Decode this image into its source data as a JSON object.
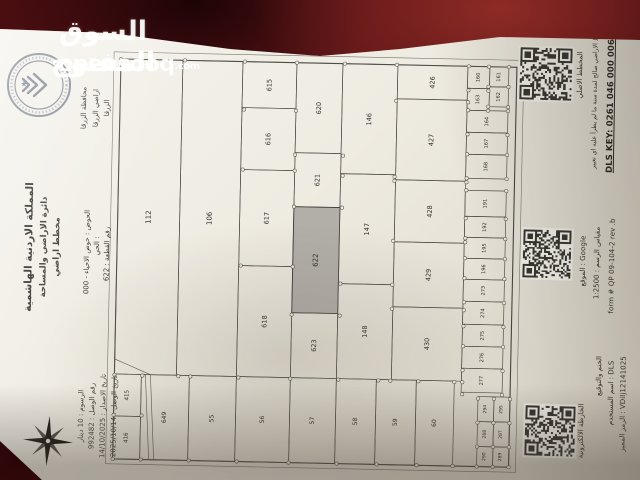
{
  "watermark": {
    "title_ar": "السوق المفتوح",
    "brand": "opensooq",
    "tld": ".com"
  },
  "paper": {
    "region": [
      "محافظة الزرقا",
      "اراضي الزرقا",
      "الزرقا"
    ],
    "header": [
      "المملكة الاردنية الهاشمية",
      "دائرة الاراضي والمساحة",
      "مخطط اراضي"
    ],
    "parcel": [
      "الحوض : حوض الاحياء - 000",
      "الحي :",
      "رقم القطعة : 622"
    ],
    "receipt": [
      "الرسوم : 10 دينار",
      "رقم الوصل : 992482",
      "تاريخ الاصدار : 14/10/2025",
      "تاريخ الوصل : 2025/10/14"
    ]
  },
  "side": {
    "original_plan": "المخطط الاصلي",
    "validity": "مخطط الاراضي صالح لمدة سنة ما لم يطرأ عليه اي تغيير",
    "dls_key": "DLS KEY: 0261 046 000 00622",
    "location": "الموقع :  Google",
    "scale": "مقياس الرسم :  1:2500",
    "form": "form # QP 09-104-2 rev .b",
    "emap": "الخارطة الالكترونية",
    "stamp": "الختم والتوقيع",
    "username": "اسم المستخدم :  DLS",
    "token": "الرمز المميز :  VDilj12141025"
  },
  "map": {
    "highlighted_plot": "622",
    "frame": {
      "w": 396,
      "h": 400
    },
    "plots": [
      {
        "n": "112",
        "x": 0,
        "y": 0,
        "w": 62,
        "h": 315,
        "fs": 7
      },
      {
        "n": "106",
        "x": 62,
        "y": 0,
        "w": 60,
        "h": 315,
        "fs": 7
      },
      {
        "n": "615",
        "x": 122,
        "y": 0,
        "w": 54,
        "h": 46,
        "fs": 6.5
      },
      {
        "n": "616",
        "x": 122,
        "y": 46,
        "w": 54,
        "h": 62,
        "fs": 6.5
      },
      {
        "n": "617",
        "x": 122,
        "y": 108,
        "w": 54,
        "h": 96,
        "fs": 6.5
      },
      {
        "n": "618",
        "x": 122,
        "y": 204,
        "w": 54,
        "h": 111,
        "fs": 6.5
      },
      {
        "n": "620",
        "x": 176,
        "y": 0,
        "w": 46,
        "h": 90,
        "fs": 6.5
      },
      {
        "n": "621",
        "x": 176,
        "y": 90,
        "w": 46,
        "h": 54,
        "fs": 6.5
      },
      {
        "n": "622",
        "x": 176,
        "y": 144,
        "w": 46,
        "h": 106,
        "fs": 7
      },
      {
        "n": "623",
        "x": 176,
        "y": 250,
        "w": 46,
        "h": 65,
        "fs": 6.5
      },
      {
        "n": "146",
        "x": 222,
        "y": 0,
        "w": 55,
        "h": 110,
        "fs": 6.5
      },
      {
        "n": "147",
        "x": 222,
        "y": 110,
        "w": 55,
        "h": 110,
        "fs": 6.5
      },
      {
        "n": "148",
        "x": 222,
        "y": 220,
        "w": 55,
        "h": 95,
        "fs": 6.5
      },
      {
        "n": "426",
        "x": 277,
        "y": 0,
        "w": 70,
        "h": 34,
        "fs": 6.5
      },
      {
        "n": "427",
        "x": 277,
        "y": 34,
        "w": 70,
        "h": 81,
        "fs": 6.5
      },
      {
        "n": "428",
        "x": 277,
        "y": 115,
        "w": 70,
        "h": 62,
        "fs": 6.5
      },
      {
        "n": "429",
        "x": 277,
        "y": 177,
        "w": 70,
        "h": 65,
        "fs": 6.5
      },
      {
        "n": "430",
        "x": 277,
        "y": 242,
        "w": 70,
        "h": 73,
        "fs": 6.5
      },
      {
        "n": "160",
        "x": 347,
        "y": 0,
        "w": 22,
        "h": 22,
        "fs": 5
      },
      {
        "n": "161",
        "x": 369,
        "y": 0,
        "w": 19,
        "h": 20,
        "fs": 5
      },
      {
        "n": "163",
        "x": 347,
        "y": 22,
        "w": 22,
        "h": 22,
        "fs": 5
      },
      {
        "n": "162",
        "x": 369,
        "y": 20,
        "w": 19,
        "h": 20,
        "fs": 5
      },
      {
        "n": "164",
        "x": 347,
        "y": 44,
        "w": 41,
        "h": 22,
        "fs": 5
      },
      {
        "n": "167",
        "x": 347,
        "y": 66,
        "w": 41,
        "h": 22,
        "fs": 5
      },
      {
        "n": "168",
        "x": 347,
        "y": 88,
        "w": 41,
        "h": 24,
        "fs": 5
      },
      {
        "n": "191",
        "x": 347,
        "y": 124,
        "w": 41,
        "h": 26,
        "fs": 5
      },
      {
        "n": "192",
        "x": 347,
        "y": 150,
        "w": 41,
        "h": 21,
        "fs": 5
      },
      {
        "n": "195",
        "x": 347,
        "y": 171,
        "w": 41,
        "h": 21,
        "fs": 5
      },
      {
        "n": "196",
        "x": 347,
        "y": 192,
        "w": 41,
        "h": 21,
        "fs": 5
      },
      {
        "n": "273",
        "x": 347,
        "y": 213,
        "w": 41,
        "h": 22,
        "fs": 5
      },
      {
        "n": "274",
        "x": 347,
        "y": 235,
        "w": 41,
        "h": 23,
        "fs": 5
      },
      {
        "n": "275",
        "x": 347,
        "y": 258,
        "w": 41,
        "h": 22,
        "fs": 5
      },
      {
        "n": "276",
        "x": 347,
        "y": 280,
        "w": 41,
        "h": 22,
        "fs": 5
      },
      {
        "n": "277",
        "x": 347,
        "y": 302,
        "w": 41,
        "h": 24,
        "fs": 5
      },
      {
        "n": "415",
        "x": 0,
        "y": 315,
        "w": 27,
        "h": 42,
        "fs": 5.5
      },
      {
        "n": "416",
        "x": 0,
        "y": 357,
        "w": 27,
        "h": 43,
        "fs": 5.5
      },
      {
        "n": "649",
        "x": 27,
        "y": 315,
        "w": 48,
        "h": 85,
        "fs": 6
      },
      {
        "n": "55",
        "x": 75,
        "y": 315,
        "w": 47,
        "h": 85,
        "fs": 6
      },
      {
        "n": "56",
        "x": 122,
        "y": 315,
        "w": 54,
        "h": 85,
        "fs": 6
      },
      {
        "n": "57",
        "x": 176,
        "y": 315,
        "w": 46,
        "h": 85,
        "fs": 6
      },
      {
        "n": "58",
        "x": 222,
        "y": 315,
        "w": 40,
        "h": 85,
        "fs": 6
      },
      {
        "n": "59",
        "x": 262,
        "y": 315,
        "w": 40,
        "h": 85,
        "fs": 6
      },
      {
        "n": "60",
        "x": 302,
        "y": 315,
        "w": 38,
        "h": 85,
        "fs": 6
      },
      {
        "n": "294",
        "x": 364,
        "y": 330,
        "w": 16,
        "h": 25,
        "fs": 4.5
      },
      {
        "n": "295",
        "x": 380,
        "y": 330,
        "w": 16,
        "h": 25,
        "fs": 4.5
      },
      {
        "n": "288",
        "x": 364,
        "y": 355,
        "w": 16,
        "h": 25,
        "fs": 4.5
      },
      {
        "n": "287",
        "x": 380,
        "y": 355,
        "w": 16,
        "h": 25,
        "fs": 4.5
      },
      {
        "n": "290",
        "x": 364,
        "y": 380,
        "w": 16,
        "h": 20,
        "fs": 4.5
      },
      {
        "n": "289",
        "x": 380,
        "y": 380,
        "w": 16,
        "h": 20,
        "fs": 4.5
      }
    ]
  }
}
